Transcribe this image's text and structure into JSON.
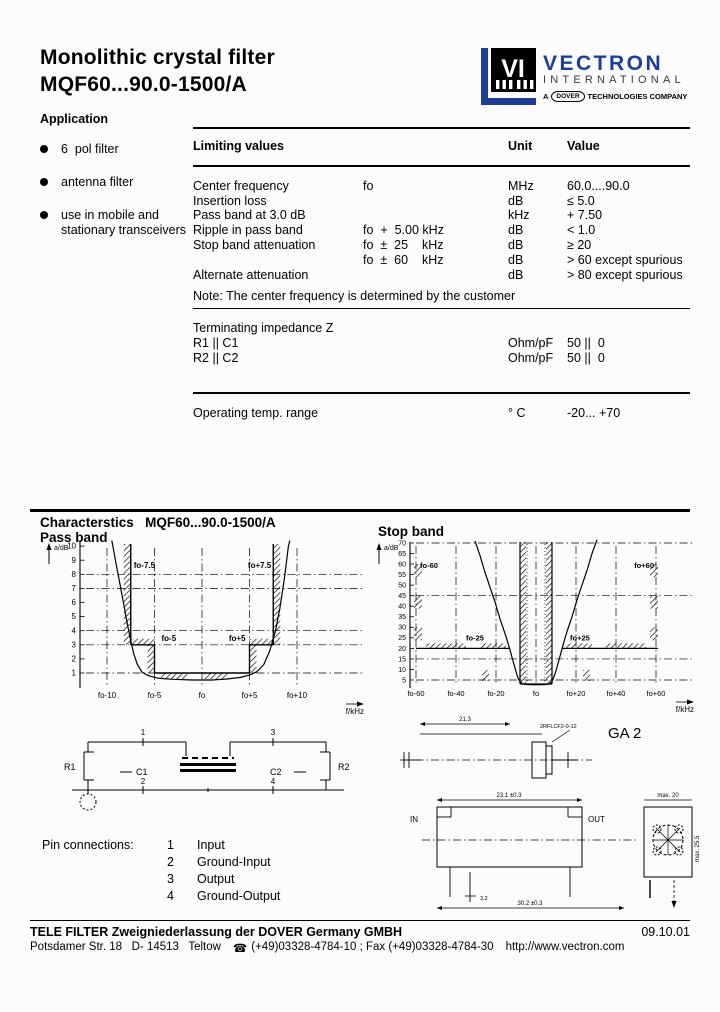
{
  "header": {
    "title_line1": "Monolithic crystal filter",
    "title_line2": "MQF60...90.0-1500/A"
  },
  "logo": {
    "vi_text": "VI",
    "brand": "VECTRON",
    "brand_sub": "INTERNATIONAL",
    "tagline_a": "A",
    "tagline_box": "DOVER",
    "tagline_rest": "TECHNOLOGIES COMPANY",
    "blue": "#1e3d96"
  },
  "application": {
    "heading": "Application",
    "items": [
      "6  pol filter",
      "antenna filter",
      "use in mobile and stationary transceivers"
    ]
  },
  "limits": {
    "col_name": "Limiting values",
    "col_unit": "Unit",
    "col_value": "Value",
    "rows": [
      {
        "name": "Center frequency",
        "cond": "fo",
        "unit": "MHz",
        "value": "60.0....90.0"
      },
      {
        "name": "Insertion loss",
        "cond": "",
        "unit": "dB",
        "value": "≤ 5.0"
      },
      {
        "name": "Pass band at 3.0 dB",
        "cond": "",
        "unit": "kHz",
        "value": "+ 7.50"
      },
      {
        "name": "Ripple in pass band",
        "cond": "fo  +  5.00 kHz",
        "unit": "dB",
        "value": "< 1.0"
      },
      {
        "name": "Stop band attenuation",
        "cond": "fo  ±  25    kHz",
        "unit": "dB",
        "value": "≥ 20"
      },
      {
        "name": "",
        "cond": "fo  ±  60    kHz",
        "unit": "dB",
        "value": "> 60 except spurious"
      },
      {
        "name": "Alternate attenuation",
        "cond": "",
        "unit": "dB",
        "value": "> 80 except spurious"
      }
    ],
    "note": "Note: The center frequency is determined by the customer",
    "impedance_heading": "Terminating impedance Z",
    "impedance_rows": [
      {
        "name": "R1 || C1",
        "unit": "Ohm/pF",
        "value": "50 ||  0"
      },
      {
        "name": "R2 || C2",
        "unit": "Ohm/pF",
        "value": "50 ||  0"
      }
    ],
    "temp_row": {
      "name": "Operating temp. range",
      "unit": "° C",
      "value": "-20... +70"
    }
  },
  "characteristics": {
    "heading": "Characterstics",
    "model": "MQF60...90.0-1500/A",
    "passband_title": "Pass band",
    "stopband_title": "Stop band"
  },
  "chart_data": [
    {
      "type": "line",
      "title": "Pass band",
      "ylabel": "a/dB",
      "xlabel": "f/kHz",
      "yticks": [
        10,
        9,
        8,
        7,
        6,
        5,
        4,
        3,
        2,
        1
      ],
      "grid_y": [
        8,
        7,
        4,
        3,
        1
      ],
      "xticks": [
        "fo-10",
        "fo-5",
        "fo",
        "fo+5",
        "fo+10"
      ],
      "xtick_offsets": [
        -10,
        -5,
        0,
        5,
        10
      ],
      "annotations": [
        "fo-7.5",
        "fo+7.5",
        "fo-5",
        "fo+5"
      ],
      "mask": {
        "outer_khz": 7.5,
        "outer_limit_db": 3,
        "inner_khz": 5,
        "ripple_db": 1
      },
      "curve": [
        [
          -9.5,
          10.4
        ],
        [
          -9.0,
          8.6
        ],
        [
          -8.5,
          6.8
        ],
        [
          -8.0,
          5.0
        ],
        [
          -7.6,
          3.6
        ],
        [
          -7.2,
          2.4
        ],
        [
          -6.8,
          1.6
        ],
        [
          -6.3,
          1.05
        ],
        [
          -5.6,
          0.8
        ],
        [
          -4.5,
          0.62
        ],
        [
          -3,
          0.55
        ],
        [
          -1,
          0.5
        ],
        [
          1,
          0.5
        ],
        [
          2.5,
          0.57
        ],
        [
          4,
          0.68
        ],
        [
          5,
          0.85
        ],
        [
          5.8,
          1.1
        ],
        [
          6.5,
          1.6
        ],
        [
          7.1,
          2.5
        ],
        [
          7.7,
          3.9
        ],
        [
          8.2,
          5.6
        ],
        [
          8.7,
          7.8
        ],
        [
          9.1,
          10.0
        ],
        [
          9.25,
          10.4
        ]
      ]
    },
    {
      "type": "line",
      "title": "Stop band",
      "ylabel": "a/dB",
      "xlabel": "f/kHz",
      "yticks": [
        70,
        65,
        60,
        55,
        50,
        45,
        40,
        35,
        30,
        25,
        20,
        15,
        10,
        5
      ],
      "grid_y": [
        70,
        45,
        15,
        5
      ],
      "xticks": [
        "fo-60",
        "fo-40",
        "fo-20",
        "fo",
        "fo+20",
        "fo+40",
        "fo+60"
      ],
      "xtick_offsets": [
        -60,
        -40,
        -20,
        0,
        20,
        40,
        60
      ],
      "annotations": [
        "fo-60",
        "fo+60",
        "fo-25",
        "fo+25"
      ],
      "mask": {
        "passband_half_khz": 8,
        "stop_limit_db": 20
      },
      "curve": [
        [
          -30.5,
          71
        ],
        [
          -28,
          64
        ],
        [
          -25.5,
          56
        ],
        [
          -23,
          49
        ],
        [
          -20.5,
          42
        ],
        [
          -18,
          34
        ],
        [
          -15.5,
          27
        ],
        [
          -13.5,
          21
        ],
        [
          -11.5,
          14
        ],
        [
          -10,
          9
        ],
        [
          -9,
          6
        ],
        [
          -8,
          4.2
        ],
        [
          -6.5,
          3.1
        ],
        [
          -4,
          2.8
        ],
        [
          0,
          2.7
        ],
        [
          4,
          2.8
        ],
        [
          6.5,
          3.1
        ],
        [
          8,
          4.4
        ],
        [
          9,
          6.5
        ],
        [
          10,
          9.5
        ],
        [
          11.5,
          14.5
        ],
        [
          13.5,
          21.5
        ],
        [
          15.5,
          28
        ],
        [
          18,
          35
        ],
        [
          20.5,
          43
        ],
        [
          23,
          50
        ],
        [
          25.5,
          57
        ],
        [
          28,
          65
        ],
        [
          30.5,
          71.5
        ]
      ]
    }
  ],
  "schematic": {
    "r1": "R1",
    "c1": "C1",
    "c2": "C2",
    "r2": "R2",
    "pin1": "1",
    "pin2": "2",
    "pin3": "3",
    "pin4": "4"
  },
  "pins": {
    "heading": "Pin connections:",
    "rows": [
      {
        "num": "1",
        "label": "Input"
      },
      {
        "num": "2",
        "label": "Ground-Input"
      },
      {
        "num": "3",
        "label": "Output"
      },
      {
        "num": "4",
        "label": "Ground-Output"
      }
    ]
  },
  "package": {
    "code": "GA 2",
    "drawing_no": "2RFLCF2-0-12",
    "label_in": "IN",
    "label_out": "OUT",
    "dims": {
      "top": "21.3",
      "width": "23.1 ±0.3",
      "bottom": "30.2 ±0.3",
      "side_w": "max. 20",
      "side_h": "max. 25.5",
      "pin": "3.2"
    }
  },
  "footer": {
    "company": "TELE FILTER Zweigniederlassung der DOVER Germany GMBH",
    "date": "09.10.01",
    "address": "Potsdamer Str. 18   D- 14513   Teltow",
    "phone_icon": "☎",
    "phone": "(+49)03328-4784-10 ; Fax (+49)03328-4784-30",
    "url": "http://www.vectron.com"
  }
}
